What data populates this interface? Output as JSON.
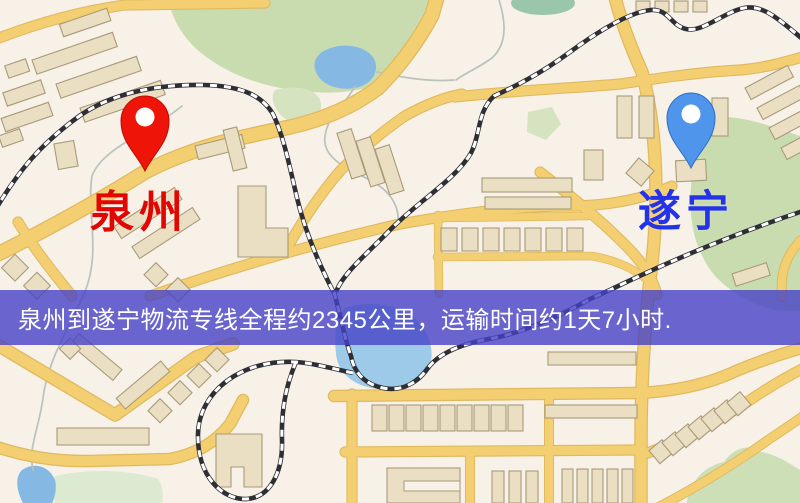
{
  "map": {
    "markers": {
      "origin": {
        "label": "泉州",
        "label_color": "#e10600",
        "pin_color": "#ee1508",
        "pin_stroke": "#c00b03"
      },
      "destination": {
        "label": "遂宁",
        "label_color": "#2433e8",
        "pin_color": "#4f95ec",
        "pin_stroke": "#2d6fc4"
      }
    },
    "banner": {
      "text": "泉州到遂宁物流专线全程约2345公里，运输时间约1天7小时.",
      "background_color": "rgba(70,66,199,0.80)",
      "text_color": "#ffffff",
      "origin_city": "泉州",
      "destination_city": "遂宁",
      "distance_km": "2345",
      "transit_time": "1天7小时"
    },
    "theme": {
      "background": "#f7f1e8",
      "road": "#f3cf72",
      "road_casing": "#e0b95f",
      "park": "#c9dcb0",
      "park_light": "#d6e3c0",
      "field_green": "#dcead2",
      "hill_green": "#ccdfb6",
      "water": "#85b9e4",
      "water_light": "#9ccae8",
      "building": "#eadfc2",
      "building_stroke": "#a99a79",
      "railway": "#2e2e35",
      "stream": "#b9c2bd"
    }
  }
}
